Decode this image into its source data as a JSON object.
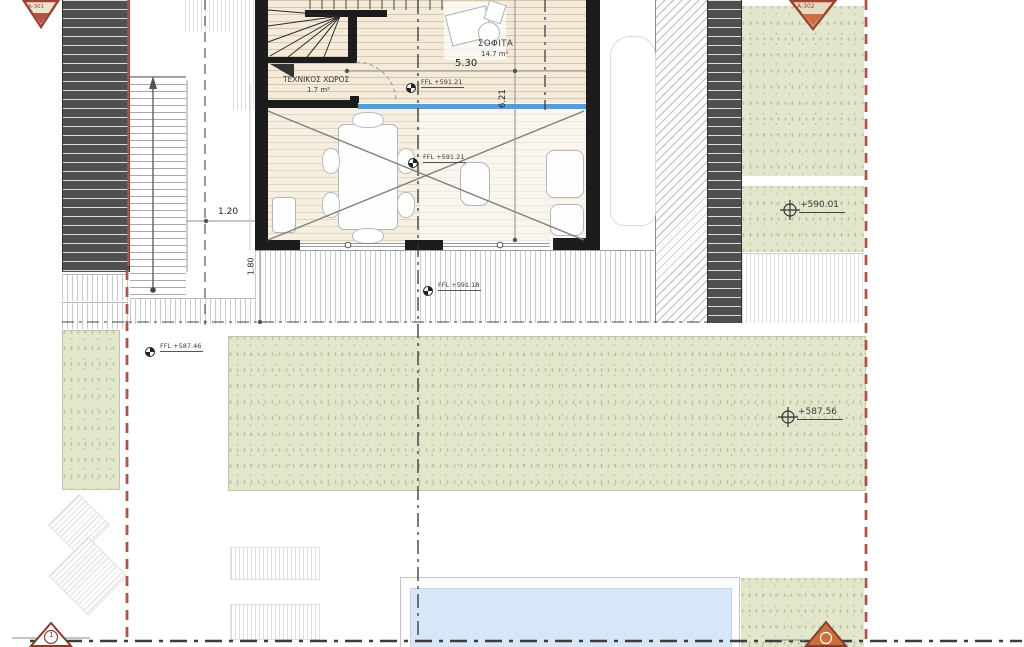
{
  "plan": {
    "rooms": {
      "attic": {
        "name": "ΣΟΦΙΤΑ",
        "area": "14.7 m²"
      },
      "technical": {
        "name": "ΤΕΧΝΙΚΟΣ ΧΩΡΟΣ",
        "area": "1.7 m²"
      }
    },
    "dimensions": {
      "attic_width": "5.30",
      "attic_depth": "6.21",
      "side_offset": "1.20",
      "terrace_depth": "1.80"
    },
    "levels": {
      "attic_ffl": "FFL +591.21",
      "void_ffl": "FFL +591.21",
      "terrace_ffl": "FFL +591.18",
      "garden_ffl": "FFL +587.46",
      "spot_mid": "+590.01",
      "spot_garden": "+587.56"
    },
    "markers": {
      "section_left": "A-301",
      "section_right": "A-302",
      "detail_left": "1"
    },
    "colors": {
      "boundary_red": "#b0544a",
      "glass_blue": "#5b9bd5",
      "pool_blue": "#d8e7f7",
      "landscape_green": "#e2e6cb",
      "structure_dark": "#4f4f4f"
    }
  }
}
